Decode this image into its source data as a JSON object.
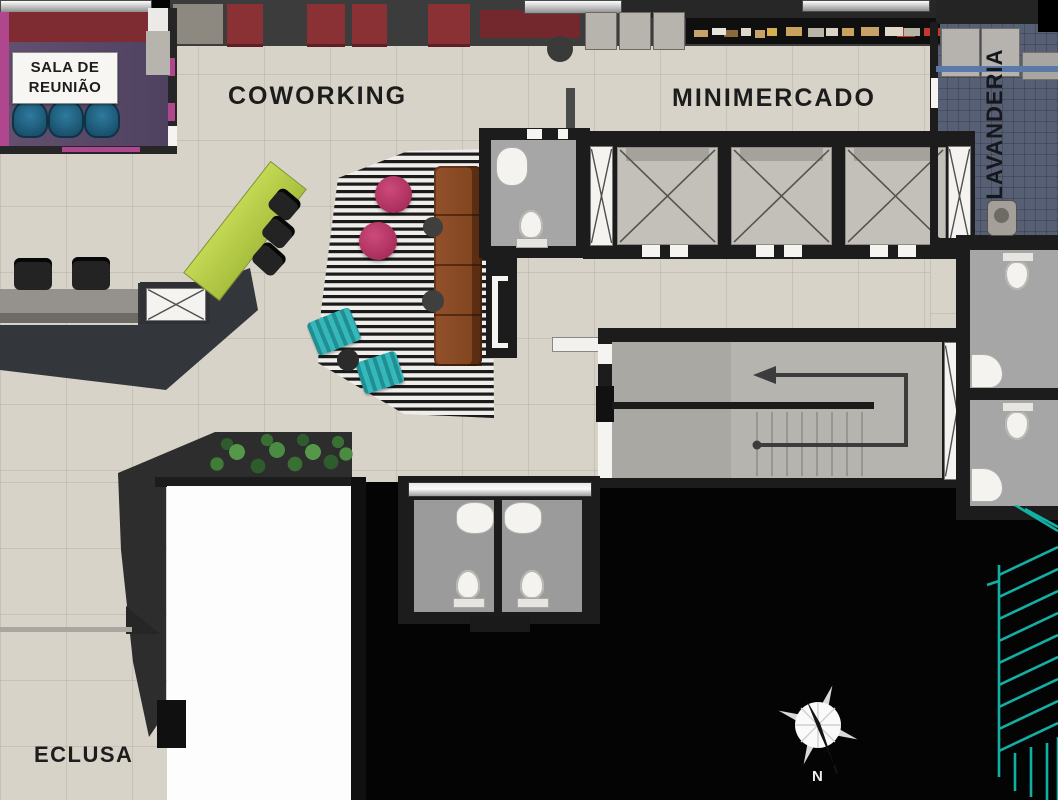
{
  "labels": {
    "meeting_room_line1": "SALA DE",
    "meeting_room_line2": "REUNIÃO",
    "coworking": "COWORKING",
    "minimercado": "MINIMERCADO",
    "lavanderia": "LAVANDERIA",
    "eclusa": "ECLUSA"
  },
  "compass": {
    "north_label": "N"
  },
  "icons": {
    "compass": "compass-rose-icon",
    "stairs": "stair-direction-arrow-icon",
    "elevator_shaft": "elevator-x-shaft-icon",
    "toilet": "toilet-icon",
    "sink": "sink-icon",
    "washer": "washing-machine-icon",
    "plant": "hedge-plant-icon",
    "wireframe": "wireframe-stairs-icon"
  },
  "colors": {
    "floor": "#d8d3c9",
    "wall": "#1c1c1c",
    "wall-mid": "#3c3c3c",
    "meeting-floor": "#5a4769",
    "pink-accent": "#b0478e",
    "red-cabinet": "#8a3136",
    "dark-red-counter": "#73282d",
    "blue-chair": "#1d5e80",
    "green-desk": "#b5cc48",
    "pink-pouf": "#b52e62",
    "teal-pouf": "#2aa4a8",
    "sofa-brown": "#8a4a26",
    "concrete": "#b2b0aa",
    "bath-floor": "#a6a6a6",
    "lavanderia-floor": "#565f74",
    "lavanderia-shelf": "#5b79a8",
    "counter-gray": "#8d8a85",
    "wire-teal": "#14b9ad",
    "text-dark": "#1c1c1c"
  }
}
